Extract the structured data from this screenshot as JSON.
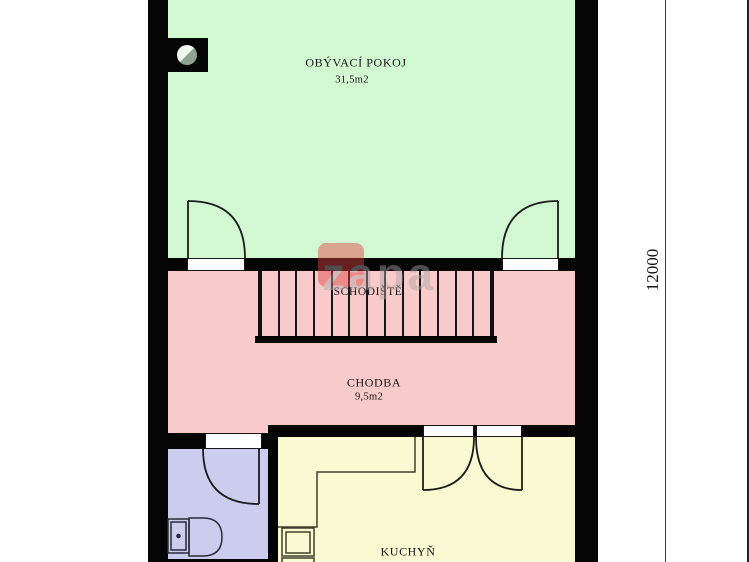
{
  "watermark": {
    "text": "zapa"
  },
  "rooms": {
    "living": {
      "name": "OBÝVACÍ POKOJ",
      "area": "31,5m2"
    },
    "staircase": {
      "name": "SCHODIŠTĚ",
      "steps": 13
    },
    "hallway": {
      "name": "CHODBA",
      "area": "9,5m2"
    },
    "kitchen": {
      "name": "KUCHYŇ"
    },
    "bathroom": {
      "fixtures": "toilet"
    }
  },
  "dimensions": {
    "right_vertical": "12000"
  },
  "colors": {
    "living": "#d2f8d2",
    "hallway": "#f9caca",
    "bathroom": "#ccccee",
    "kitchen": "#fafad2",
    "wall": "#050505",
    "watermark_accent": "#e04040",
    "watermark_text": "#aaa4a4"
  }
}
